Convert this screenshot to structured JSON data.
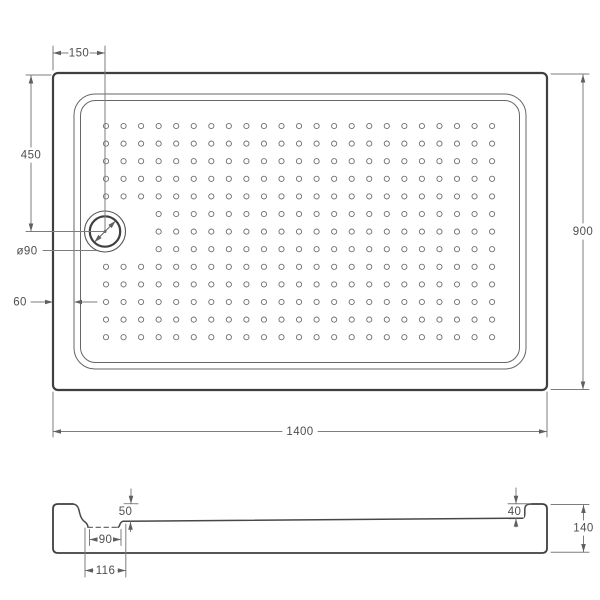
{
  "drawing": {
    "kind": "shower-tray-technical-drawing",
    "background": "#ffffff",
    "colors": {
      "outline_dark": "#3f3f3f",
      "line_medium": "#666666",
      "profile": "#474747",
      "dim_line": "#7d7d7d",
      "arrow": "#5f5f5f",
      "text": "#4f4f4f"
    },
    "views": {
      "top": {
        "name": "top-view-plan",
        "dims": {
          "drain_offset_x": "150",
          "drain_offset_y": "450",
          "drain_diameter": "ø90",
          "rim_width": "60",
          "length": "1400",
          "width": "900"
        },
        "dot_grid": {
          "cols": 23,
          "rows": 13,
          "skip_rows": [
            5,
            6,
            7
          ],
          "skip_cols": [
            0,
            1,
            2
          ]
        }
      },
      "side": {
        "name": "side-section-view",
        "dims": {
          "depth_at_drain": "50",
          "drain_hole_width": "90",
          "recess_width": "116",
          "depth_right": "40",
          "total_height": "140"
        }
      }
    }
  }
}
